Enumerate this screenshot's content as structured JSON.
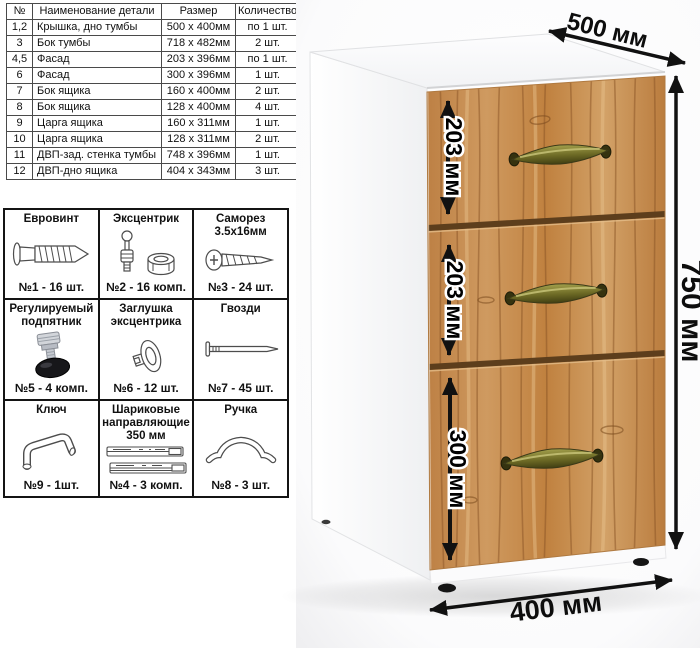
{
  "parts_table": {
    "headers": [
      "№",
      "Наименование детали",
      "Размер",
      "Количество"
    ],
    "rows": [
      {
        "num": "1,2",
        "name": "Крышка, дно тумбы",
        "size": "500 х 400мм",
        "qty": "по 1 шт."
      },
      {
        "num": "3",
        "name": "Бок тумбы",
        "size": "718 х 482мм",
        "qty": "2 шт."
      },
      {
        "num": "4,5",
        "name": "Фасад",
        "size": "203 х 396мм",
        "qty": "по 1 шт."
      },
      {
        "num": "6",
        "name": "Фасад",
        "size": "300 х 396мм",
        "qty": "1 шт."
      },
      {
        "num": "7",
        "name": "Бок ящика",
        "size": "160 х 400мм",
        "qty": "2 шт."
      },
      {
        "num": "8",
        "name": "Бок ящика",
        "size": "128 х 400мм",
        "qty": "4 шт."
      },
      {
        "num": "9",
        "name": "Царга ящика",
        "size": "160 х 311мм",
        "qty": "1 шт."
      },
      {
        "num": "10",
        "name": "Царга ящика",
        "size": "128 х 311мм",
        "qty": "2 шт."
      },
      {
        "num": "11",
        "name": "ДВП-зад. стенка тумбы",
        "size": "748 х 396мм",
        "qty": "1 шт."
      },
      {
        "num": "12",
        "name": "ДВП-дно ящика",
        "size": "404 х 343мм",
        "qty": "3 шт."
      }
    ]
  },
  "hardware": {
    "items": [
      {
        "title": "Евровинт",
        "label": "№1 - 16 шт.",
        "icon": "euro-screw-icon"
      },
      {
        "title": "Эксцентрик",
        "label": "№2 - 16 комп.",
        "icon": "cam-lock-icon"
      },
      {
        "title": "Саморез 3.5х16мм",
        "label": "№3 - 24 шт.",
        "icon": "self-tapping-screw-icon"
      },
      {
        "title": "Регулируемый подпятник",
        "label": "№5 - 4 комп.",
        "icon": "adjustable-foot-icon"
      },
      {
        "title": "Заглушка эксцентрика",
        "label": "№6 - 12 шт.",
        "icon": "cam-cap-icon"
      },
      {
        "title": "Гвозди",
        "label": "№7 - 45 шт.",
        "icon": "nails-icon"
      },
      {
        "title": "Ключ",
        "label": "№9 - 1шт.",
        "icon": "hex-key-icon"
      },
      {
        "title": "Шариковые направляющие 350 мм",
        "label": "№4 - 3 комп.",
        "icon": "ball-bearing-slides-icon"
      },
      {
        "title": "Ручка",
        "label": "№8 - 3 шт.",
        "icon": "handle-icon"
      }
    ]
  },
  "cabinet": {
    "dim_depth": "500 мм",
    "dim_height": "750 мм",
    "dim_width": "400 мм",
    "drawers": [
      {
        "height_label": "203 мм"
      },
      {
        "height_label": "203 мм"
      },
      {
        "height_label": "300 мм"
      }
    ],
    "colors": {
      "body": "#ffffff",
      "wood": "#c68b4d",
      "wood_dark": "#a96f38",
      "handle_brass": "#7d7a33",
      "arrow": "#111111"
    }
  }
}
